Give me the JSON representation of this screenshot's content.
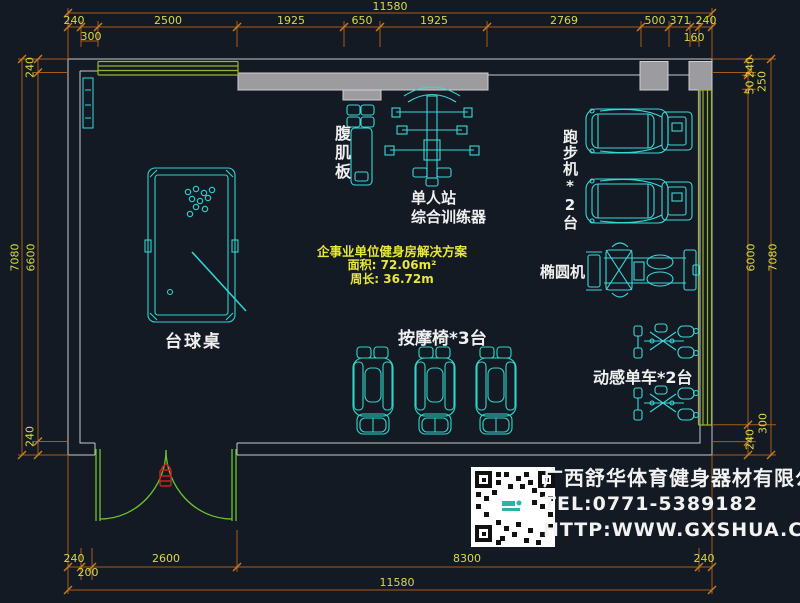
{
  "drawing": {
    "equipment_labels": {
      "ab_board": "腹肌板",
      "trainer_line1": "单人站",
      "trainer_line2": "综合训练器",
      "treadmill": "跑步机*2台",
      "elliptical": "椭圆机",
      "pool_table": "台球桌",
      "massage_chair": "按摩椅*3台",
      "spin_bike": "动感单车*2台"
    },
    "solution_note": {
      "title": "企事业单位健身房解决方案",
      "area": "面积: 72.06m²",
      "perimeter": "周长: 36.72m"
    }
  },
  "dimensions": {
    "top_total": "11580",
    "top_row": [
      "240",
      "2500",
      "1925",
      "650",
      "1925",
      "2769",
      "500",
      "371",
      "240"
    ],
    "top_sub_row": [
      "300",
      "160"
    ],
    "left": {
      "top": "240",
      "outer_total": "7080",
      "inner": "6600",
      "bottom": "240"
    },
    "right": {
      "top": "240",
      "seg_50": "50",
      "seg_250": "250",
      "inner": "6000",
      "outer_total": "7080",
      "seg_300": "300",
      "bottom": "240"
    },
    "bottom_row": [
      "240",
      "2600",
      "8300",
      "240"
    ],
    "bottom_sub": "200",
    "bottom_total": "11580"
  },
  "company": {
    "name": "广西舒华体育健身器材有限公司",
    "tel": "TEL:0771-5389182",
    "website": "HTTP:WWW.GXSHUA.COM"
  },
  "colors": {
    "background": "#141a23",
    "equipment_cyan": "#38d8d8",
    "dimension_line": "#a85c1a",
    "dimension_text": "#d9d943",
    "wall_line": "#c9c9c9",
    "wall_fill": "#9c9ca0",
    "window_green": "#9ab335",
    "door_green": "#6cc32f",
    "label_white": "#f0f0f0",
    "handle_red": "#cc2020"
  }
}
